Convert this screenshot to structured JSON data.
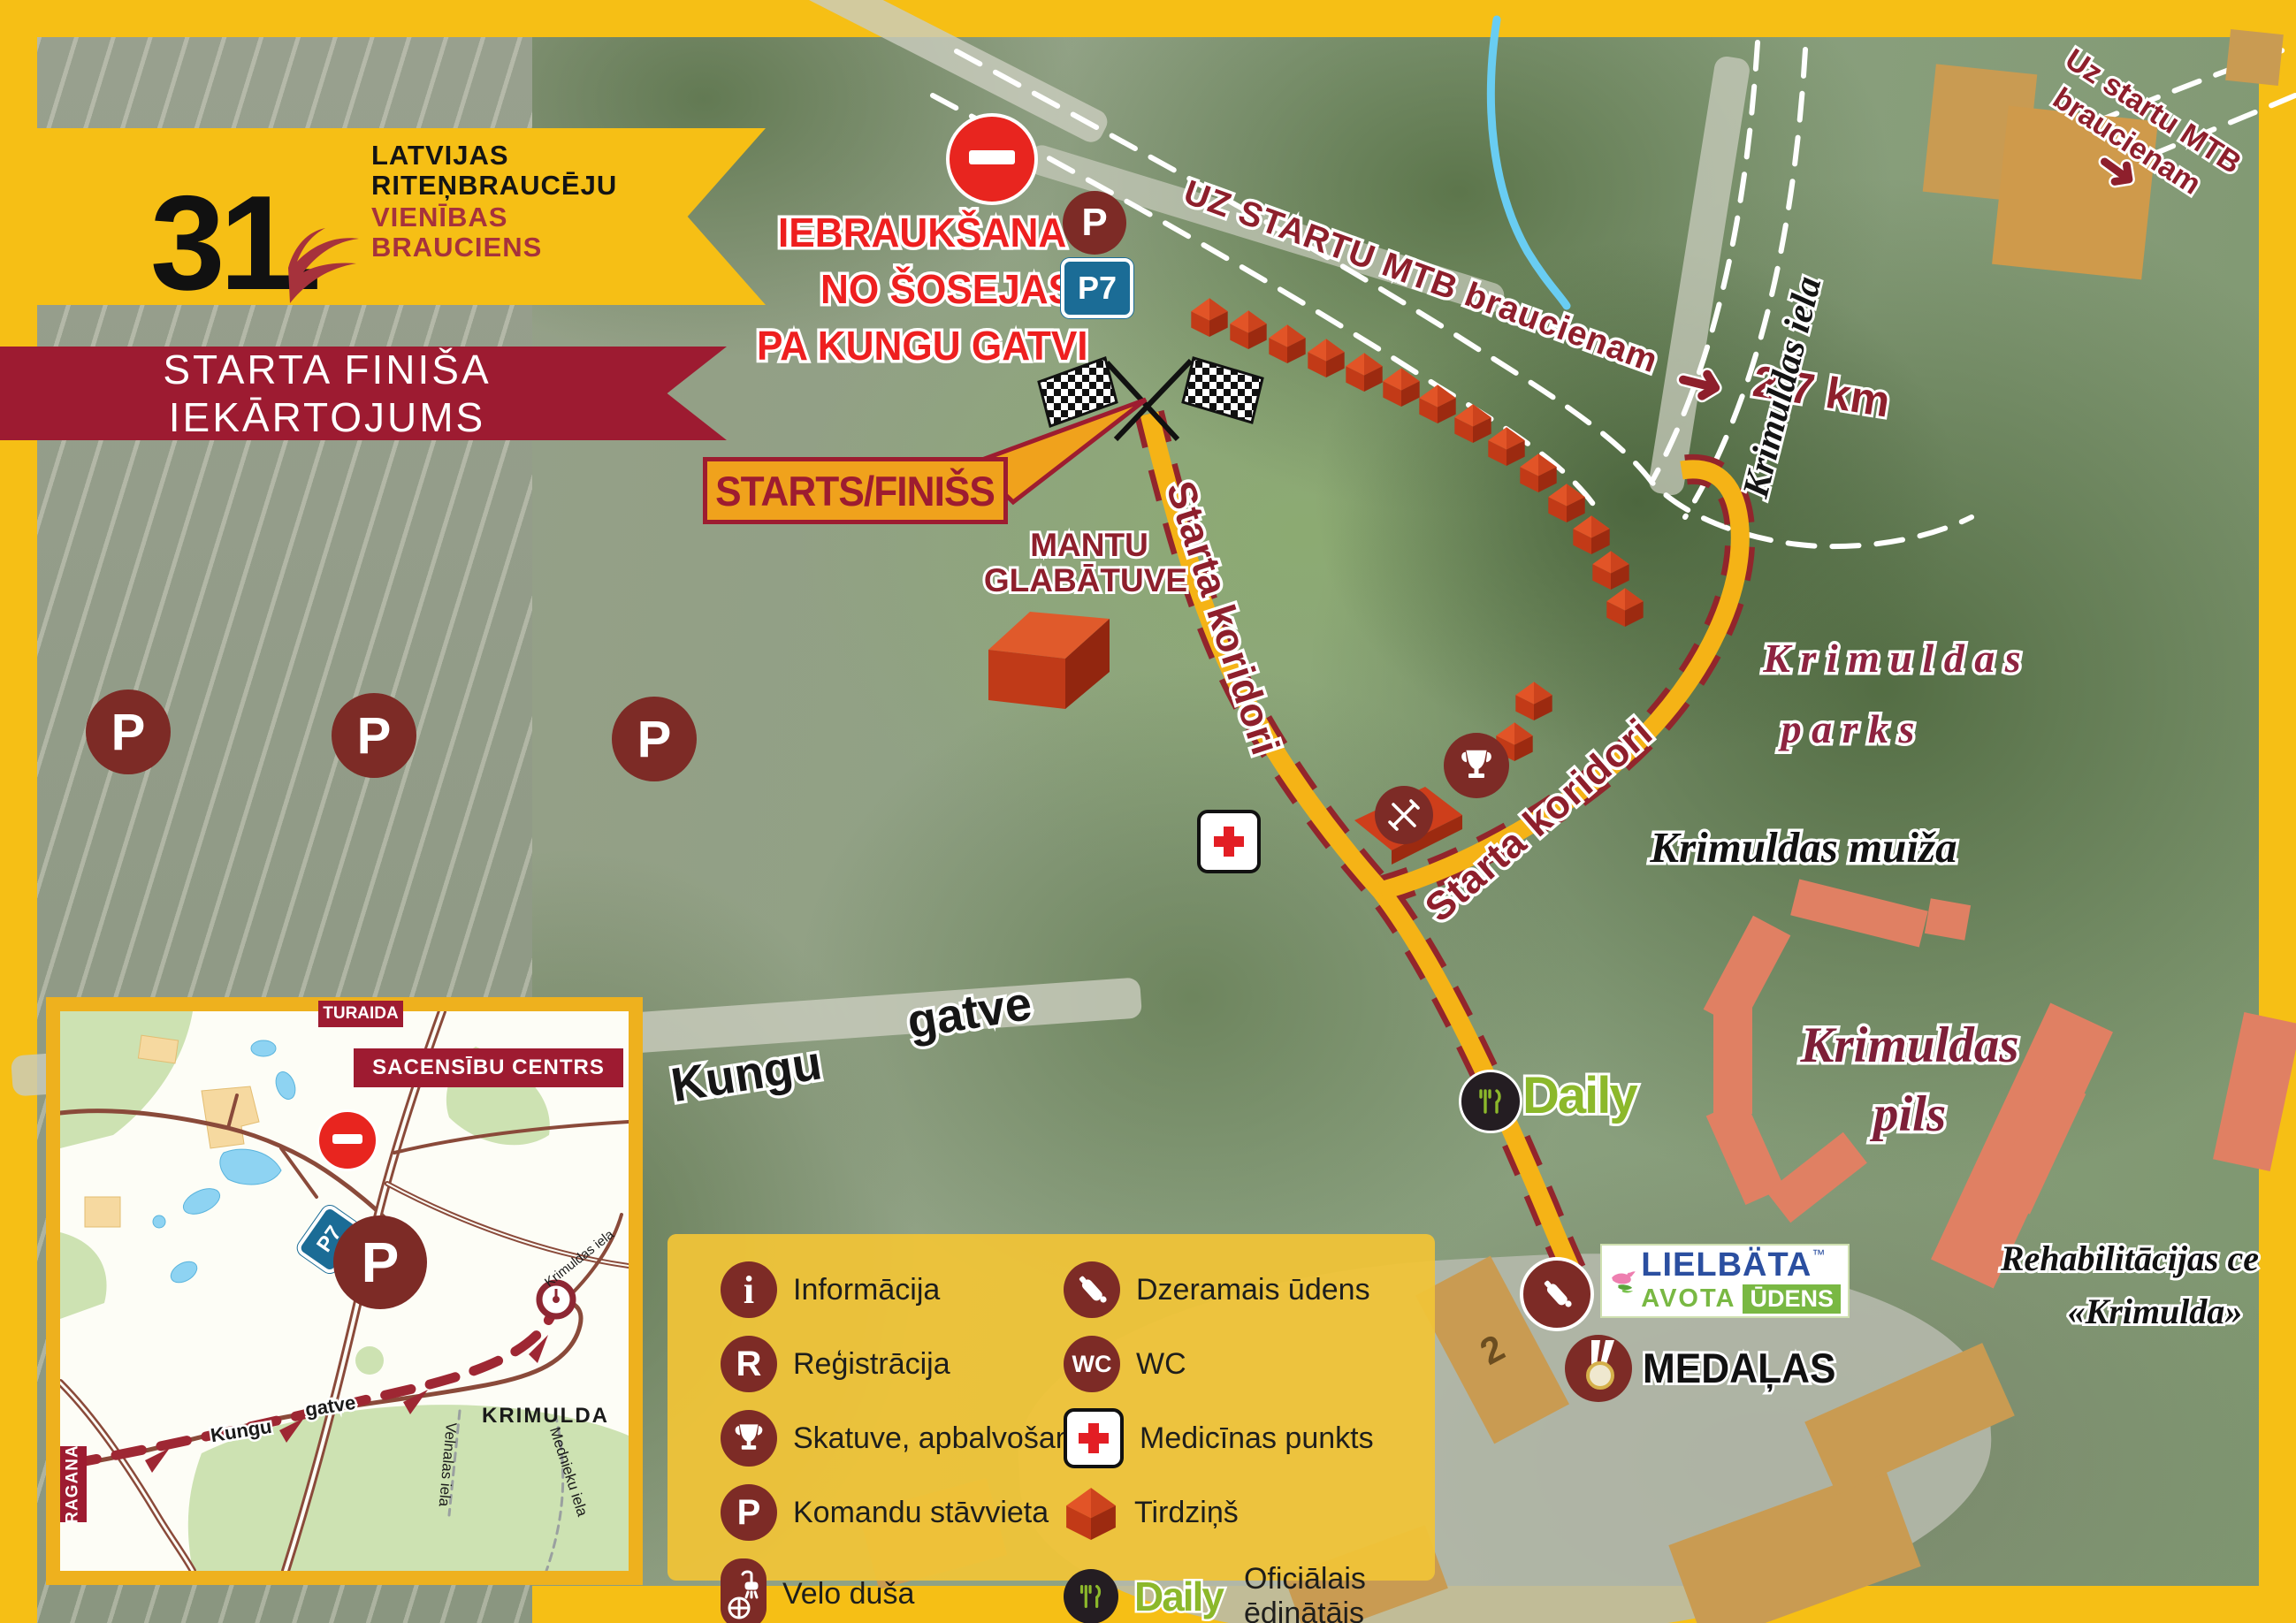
{
  "event": {
    "edition": "31.",
    "org_line1": "LATVIJAS",
    "org_line2": "RITEŅBRAUCĒJU",
    "org_line3": "VIENĪBAS",
    "org_line4": "BRAUCIENS"
  },
  "ribbon_title": "STARTA FINIŠA IEKĀRTOJUMS",
  "entry": {
    "line1": "IEBRAUKŠANA",
    "line2": "NO ŠOSEJAS",
    "line3": "PA KUNGU GATVI",
    "parking_letter": "P",
    "road_code": "P7"
  },
  "mtb": {
    "route_label": "UZ STARTU MTB braucienam",
    "distance": "2,7 km",
    "corner_line1": "Uz startu MTB",
    "corner_line2": "braucienam"
  },
  "start_finish_label": "STARTS/FINIŠS",
  "storage": {
    "line1": "MANTU",
    "line2": "GLABĀTUVE"
  },
  "corridor_label_1": "Starta koridori",
  "corridor_label_2": "Starta koridori",
  "places": {
    "krimuldas_iela": "Krimuldas iela",
    "parks_line1": "K r i m u l d a s",
    "parks_line2": "p a r k s",
    "muiza": "Krimuldas muiža",
    "pils_line1": "Krimuldas",
    "pils_line2": "pils",
    "rehab_line1": "Rehabilitācijas ce",
    "rehab_line2": "«Krimulda»",
    "kungu": "Kungu",
    "gatve": "gatve"
  },
  "field_parking_letter": "P",
  "map_marks": {
    "daily_wordmark": "Daily",
    "medals_label": "MEDAĻAS",
    "building_number": "2",
    "lielbata_brand": "LIELBÄTA",
    "lielbata_tm": "™",
    "lielbata_avota": "AVOTA",
    "lielbata_udens": "ŪDENS"
  },
  "legend": {
    "i_letter": "i",
    "r_letter": "R",
    "p_letter": "P",
    "wc_text": "WC",
    "daily_wordmark": "Daily",
    "left": [
      {
        "icon": "info-icon",
        "label": "Informācija"
      },
      {
        "icon": "registration-icon",
        "label": "Reģistrācija"
      },
      {
        "icon": "trophy-icon",
        "label": "Skatuve, apbalvošana"
      },
      {
        "icon": "parking-icon",
        "label": "Komandu stāvvieta"
      },
      {
        "icon": "bike-shower-icon",
        "label": "Velo duša"
      }
    ],
    "right": [
      {
        "icon": "water-bottle-icon",
        "label": "Dzeramais ūdens"
      },
      {
        "icon": "wc-icon",
        "label": "WC"
      },
      {
        "icon": "medical-icon",
        "label": "Medicīnas punkts"
      },
      {
        "icon": "tent-icon",
        "label": "Tirdziņš"
      },
      {
        "icon": "daily-logo",
        "label": "Oficiālais ēdinātājs"
      }
    ],
    "right_last_label_line1": "Oficiālais",
    "right_last_label_line2": "ēdinātājs"
  },
  "inset": {
    "turaida": "TURAIDA",
    "center_label": "SACENSĪBU CENTRS",
    "krimulda": "KRIMULDA",
    "ragana": "RAGANA",
    "road_code": "P7",
    "parking_letter": "P",
    "streets": {
      "kungu": "Kungu",
      "gatve": "gatve",
      "krimuldas_iela": "Krimuldas iela",
      "velnalas_iela": "Velnalas iela",
      "mednieku_iela": "Mednieku iela"
    }
  },
  "colors": {
    "frame_yellow": "#f6bf15",
    "ribbon_maroon": "#9d1b31",
    "icon_maroon": "#7d2b26",
    "bright_red": "#ee1f1f",
    "corridor_yellow": "#f5b316",
    "corridor_dash": "#92252c",
    "daily_green": "#8cb82b",
    "sign_blue": "#1b6c96",
    "salmon_building": "#e08063",
    "tan_building": "#c99b52"
  }
}
